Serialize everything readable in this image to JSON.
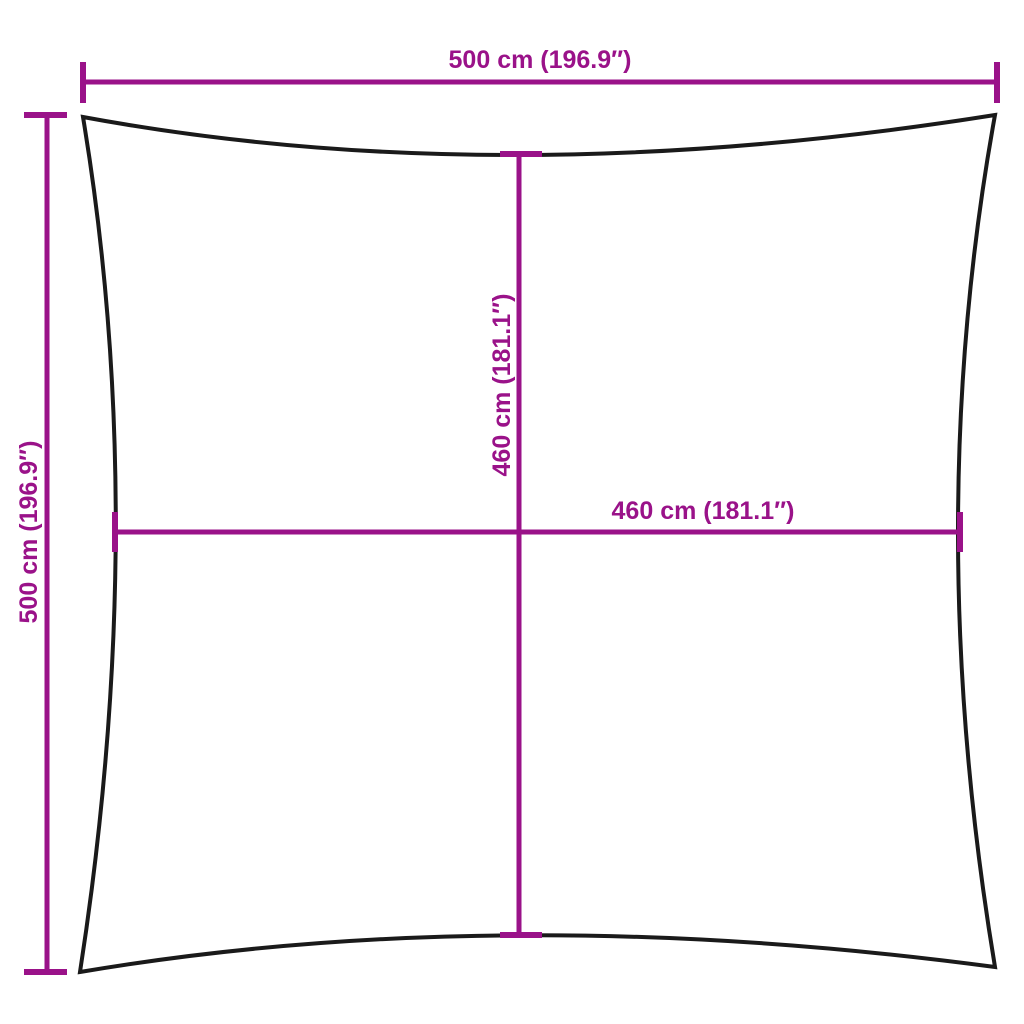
{
  "diagram": {
    "type": "dimension-diagram",
    "subject": "square shade sail outline with concave edges",
    "background_color": "#ffffff",
    "accent_color": "#9A1289",
    "outline_color": "#1a1a1a",
    "dimensions": {
      "top": {
        "label": "500 cm (196.9″)",
        "value_cm": 500,
        "value_inches": 196.9
      },
      "left": {
        "label": "500 cm (196.9″)",
        "value_cm": 500,
        "value_inches": 196.9
      },
      "inner_vertical": {
        "label": "460 cm (181.1″)",
        "value_cm": 460,
        "value_inches": 181.1
      },
      "inner_horizontal": {
        "label": "460 cm (181.1″)",
        "value_cm": 460,
        "value_inches": 181.1
      }
    }
  }
}
